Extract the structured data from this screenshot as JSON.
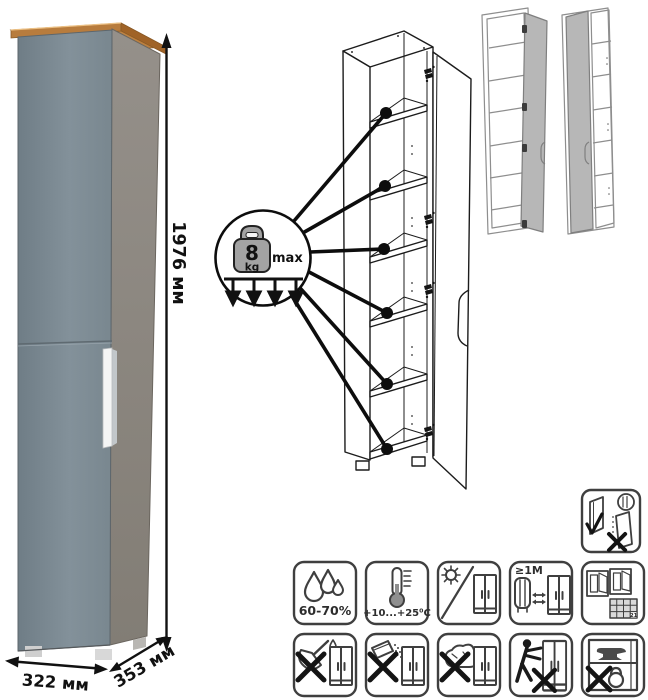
{
  "product": {
    "kind": "tall-single-door-cabinet",
    "door_color": "#7d8b94",
    "side_color": "#8d8880",
    "top_accent_color": "#c9924f",
    "handle_color": "#f4f5f5"
  },
  "dimensions": {
    "height": "1976 мм",
    "width": "322 мм",
    "depth": "353 мм"
  },
  "shelf_load": {
    "value": "8",
    "unit": "kg",
    "qualifier": "max",
    "pointed_shelves": 6
  },
  "care_icons": {
    "door_adjustment": {
      "name": "door-adjustment-icon"
    },
    "row1": [
      {
        "name": "humidity-icon",
        "label": "60-70%"
      },
      {
        "name": "temperature-range-icon",
        "label": "+10...+25⁰C"
      },
      {
        "name": "no-direct-sunlight-icon",
        "label": ""
      },
      {
        "name": "heater-distance-icon",
        "label": "≥1M"
      },
      {
        "name": "acclimatization-calendar-icon",
        "label": "21"
      }
    ],
    "row2": [
      {
        "name": "no-wet-cleaning-icon"
      },
      {
        "name": "no-abrasive-powder-icon"
      },
      {
        "name": "no-solvent-sponge-icon"
      },
      {
        "name": "no-dragging-icon"
      },
      {
        "name": "no-overload-icon"
      }
    ]
  }
}
